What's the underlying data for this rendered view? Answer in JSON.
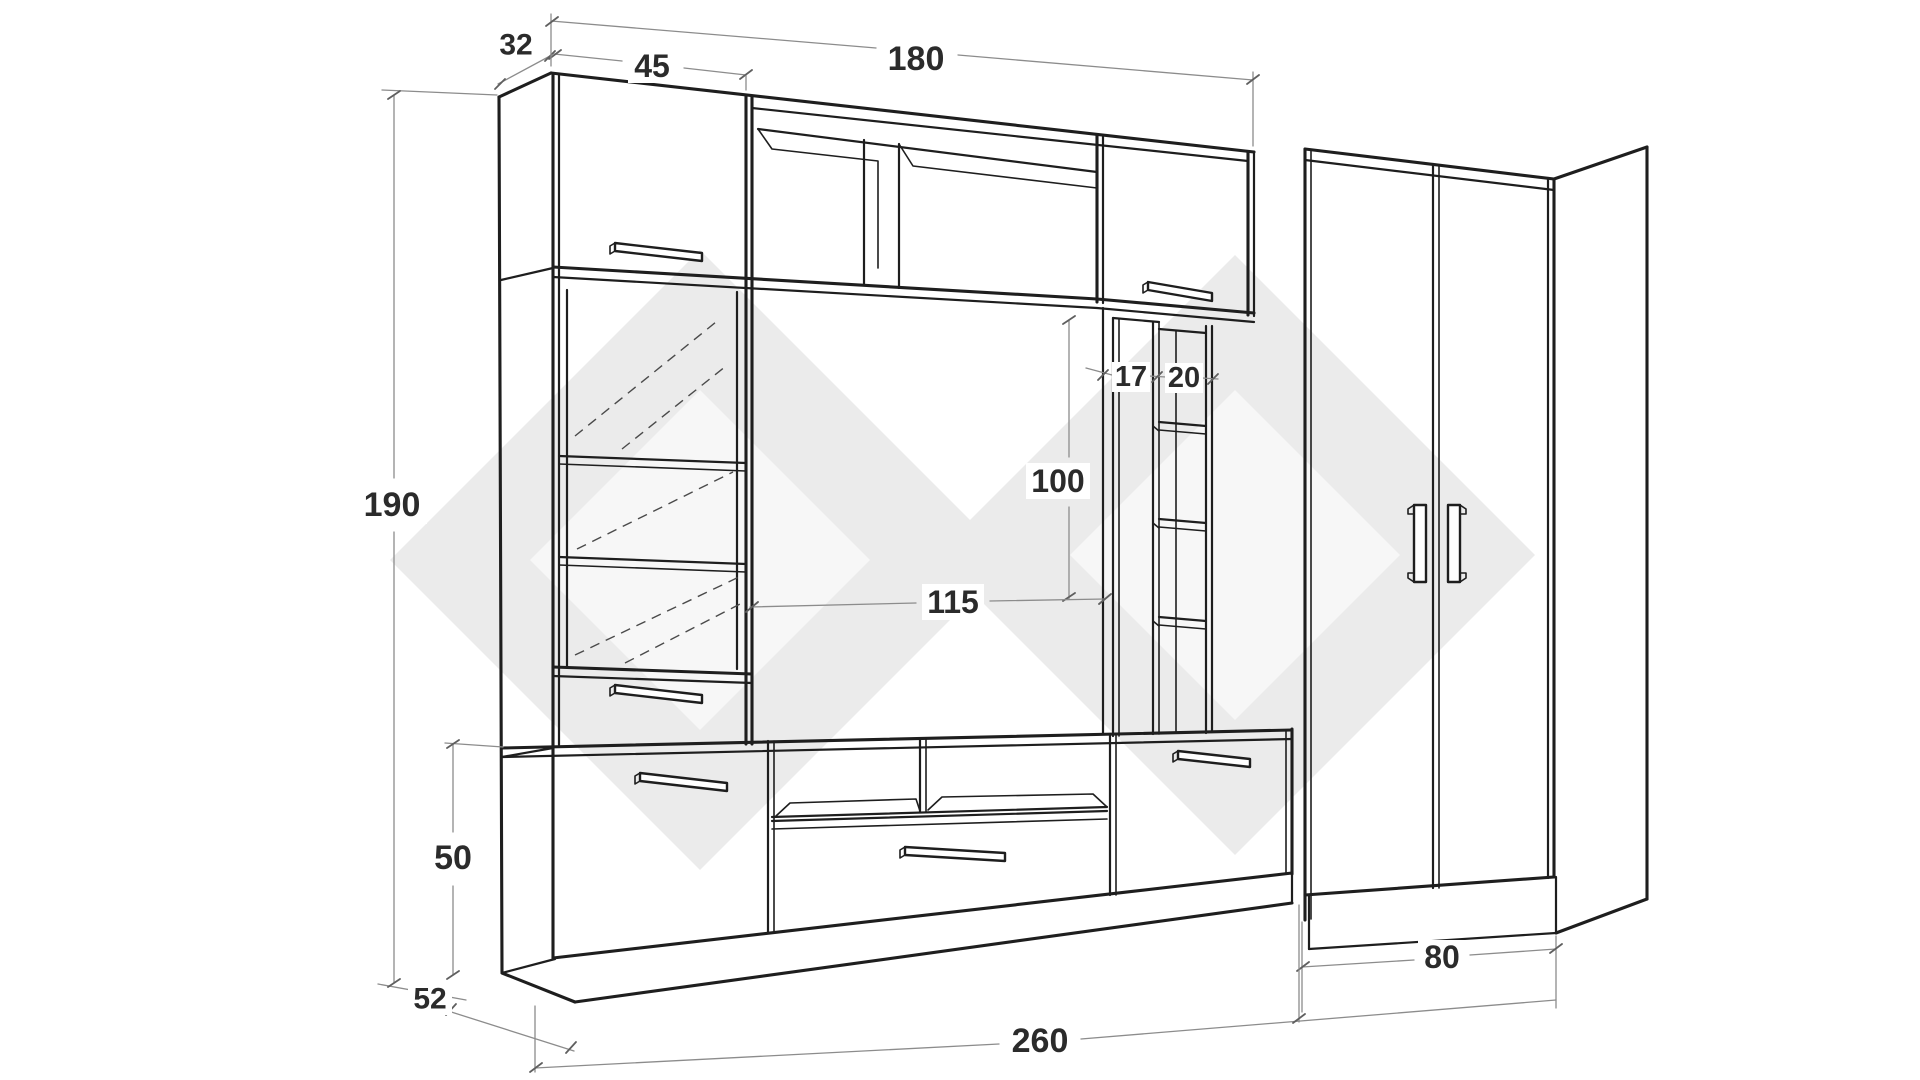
{
  "diagram": {
    "type": "furniture-dimension-drawing",
    "dimension_labels": [
      {
        "id": "dim-32",
        "text": "32",
        "x": 516,
        "y": 45,
        "font_size": 30,
        "box_w": 42,
        "box_h": 32
      },
      {
        "id": "dim-45",
        "text": "45",
        "x": 652,
        "y": 66,
        "font_size": 32,
        "box_w": 48,
        "box_h": 34
      },
      {
        "id": "dim-180",
        "text": "180",
        "x": 916,
        "y": 59,
        "font_size": 34,
        "box_w": 70,
        "box_h": 36
      },
      {
        "id": "dim-190",
        "text": "190",
        "x": 392,
        "y": 505,
        "font_size": 34,
        "box_w": 70,
        "box_h": 38
      },
      {
        "id": "dim-100",
        "text": "100",
        "x": 1058,
        "y": 481,
        "font_size": 32,
        "box_w": 64,
        "box_h": 36
      },
      {
        "id": "dim-115",
        "text": "115",
        "x": 953,
        "y": 602,
        "font_size": 32,
        "box_w": 62,
        "box_h": 36
      },
      {
        "id": "dim-17",
        "text": "17",
        "x": 1131,
        "y": 377,
        "font_size": 29,
        "box_w": 38,
        "box_h": 30
      },
      {
        "id": "dim-20",
        "text": "20",
        "x": 1184,
        "y": 378,
        "font_size": 29,
        "box_w": 38,
        "box_h": 30
      },
      {
        "id": "dim-50",
        "text": "50",
        "x": 453,
        "y": 858,
        "font_size": 34,
        "box_w": 50,
        "box_h": 36
      },
      {
        "id": "dim-52",
        "text": "52",
        "x": 430,
        "y": 999,
        "font_size": 30,
        "box_w": 44,
        "box_h": 32
      },
      {
        "id": "dim-260",
        "text": "260",
        "x": 1040,
        "y": 1041,
        "font_size": 34,
        "box_w": 70,
        "box_h": 38
      },
      {
        "id": "dim-80",
        "text": "80",
        "x": 1442,
        "y": 957,
        "font_size": 32,
        "box_w": 48,
        "box_h": 34
      }
    ]
  },
  "colors": {
    "background": "#ffffff",
    "line": "#1e1e1e",
    "dimension_line": "#8c8c8c",
    "label_text": "#2b2b2b",
    "watermark": "#ebebeb"
  }
}
